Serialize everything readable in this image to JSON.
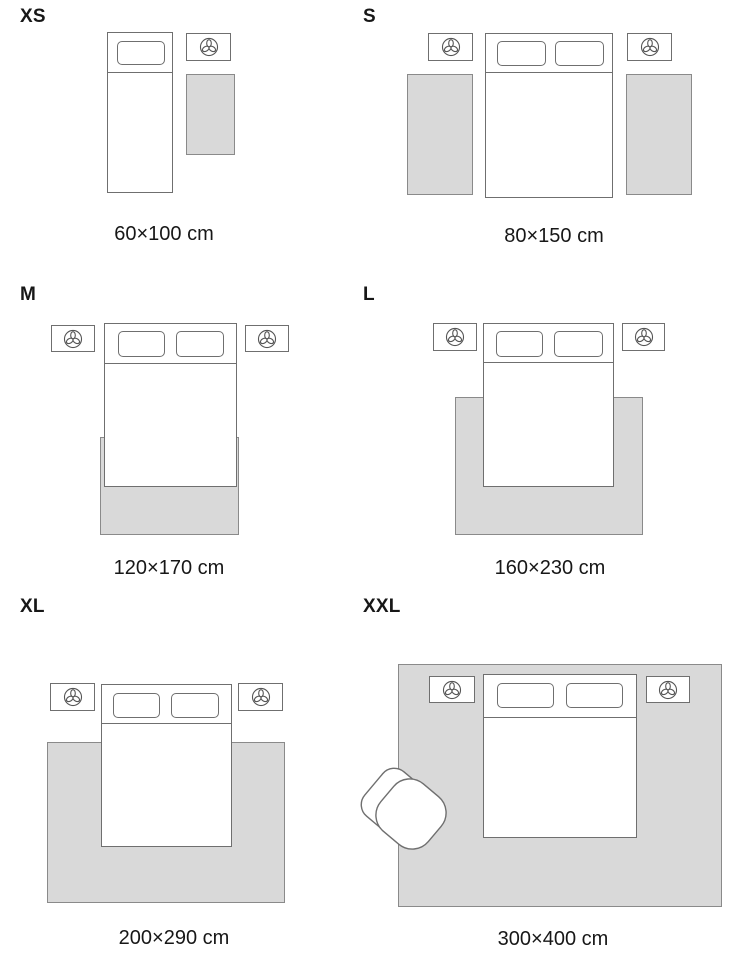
{
  "guide": {
    "subject": "rug size guide with bedroom placement",
    "unit": "cm"
  },
  "sizes": [
    {
      "id": "xs",
      "label": "XS",
      "dimensions": "60×100 cm",
      "placement": "runner beside single bed"
    },
    {
      "id": "s",
      "label": "S",
      "dimensions": "80×150 cm",
      "placement": "two runners flanking double bed"
    },
    {
      "id": "m",
      "label": "M",
      "dimensions": "120×170 cm",
      "placement": "under lower half of bed"
    },
    {
      "id": "l",
      "label": "L",
      "dimensions": "160×230 cm",
      "placement": "under lower half of bed, wider"
    },
    {
      "id": "xl",
      "label": "XL",
      "dimensions": "200×290 cm",
      "placement": "under bed and nightstand zone"
    },
    {
      "id": "xxl",
      "label": "XXL",
      "dimensions": "300×400 cm",
      "placement": "full room including bed, nightstands and armchair"
    }
  ],
  "colors": {
    "rug_fill": "#d9d9d9",
    "rug_border": "#8a8a8a",
    "furniture_stroke": "#6f6f6f",
    "furniture_fill": "#ffffff",
    "icon_stroke": "#555555",
    "text": "#171717",
    "background": "#ffffff"
  },
  "icons": {
    "nightstand_icon": "plant-icon",
    "seating_icon": "armchair-icon"
  }
}
